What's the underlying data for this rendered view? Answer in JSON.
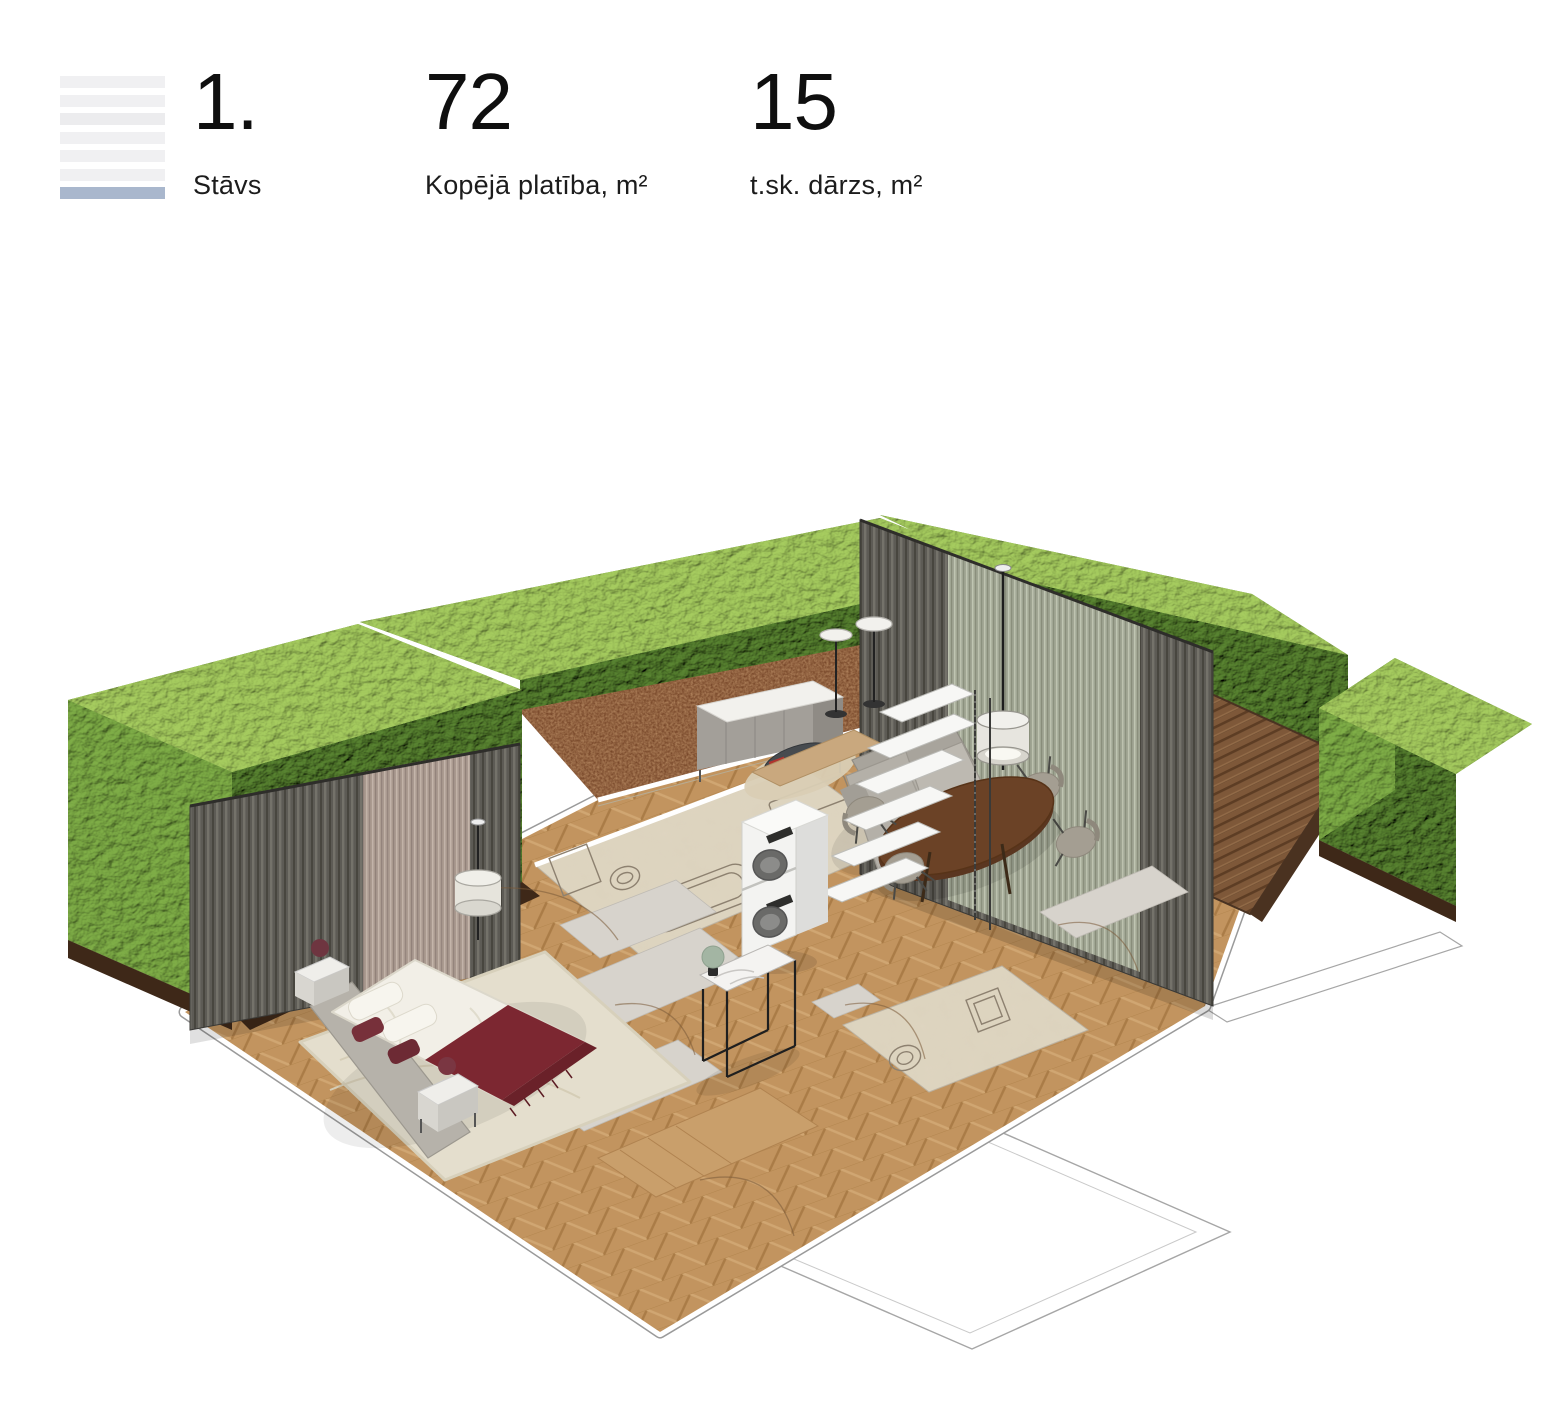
{
  "header": {
    "floor_icon": {
      "icon": "floor-level-icon",
      "bars_total": 7,
      "active_bar_index": 7,
      "active_color": "#a9b7cd",
      "inactive_color": "#f0f0f2"
    },
    "stats": [
      {
        "value": "1.",
        "label": "Stāvs"
      },
      {
        "value": "72",
        "label": "Kopējā platība, m²"
      },
      {
        "value": "15",
        "label": "t.sk. dārzs, m²"
      }
    ]
  },
  "floorplan": {
    "type": "isometric-3d-apartment-render",
    "elements": [
      "perimeter hedge walls",
      "garden soil bed",
      "wooden deck terrace",
      "herringbone parquet floor",
      "pleated curtain wall with sheer panel (living room)",
      "pleated curtain wall with sheer panel (bedroom)",
      "double bed with white duvet and burgundy throw",
      "upholstered bed frame",
      "two nightstands with burgundy sphere lamps",
      "cream bedroom rug",
      "bathroom with bathtub, sink and toilet outlines",
      "WC with toilet and shower outlines",
      "stacked washer and dryer",
      "open ladder shelving unit",
      "wall cabinet sideboard",
      "round dark side table on beige rug",
      "gray fabric corner sofa",
      "oval walnut dining table",
      "four upholstered dining chairs",
      "cylinder-shade floor lamps",
      "flat-disc floor lamps",
      "marble console table with sage sphere lamp",
      "door swing arcs",
      "outlined adjacent rooms"
    ]
  },
  "colors": {
    "background": "#ffffff",
    "text": "#111111",
    "accent_blue": "#a9b7cd",
    "icon_gray": "#f0f0f2",
    "hedge_green_top": "#8fbe52",
    "hedge_green_mid": "#6f9c3e",
    "hedge_green_dark": "#47701f",
    "soil_brown": "#6b3a1e",
    "parquet": "#c2945f",
    "deck_wood": "#7e5839",
    "curtain_gray": "#5d5b55",
    "sheer_green": "#aab0a0",
    "sheer_pink": "#b3a298",
    "tile_beige": "#ded5c0",
    "rug_cream": "#e4decd",
    "throw_burgundy": "#7c2731",
    "sofa_gray": "#bdb9b1",
    "table_walnut": "#6b4226"
  }
}
